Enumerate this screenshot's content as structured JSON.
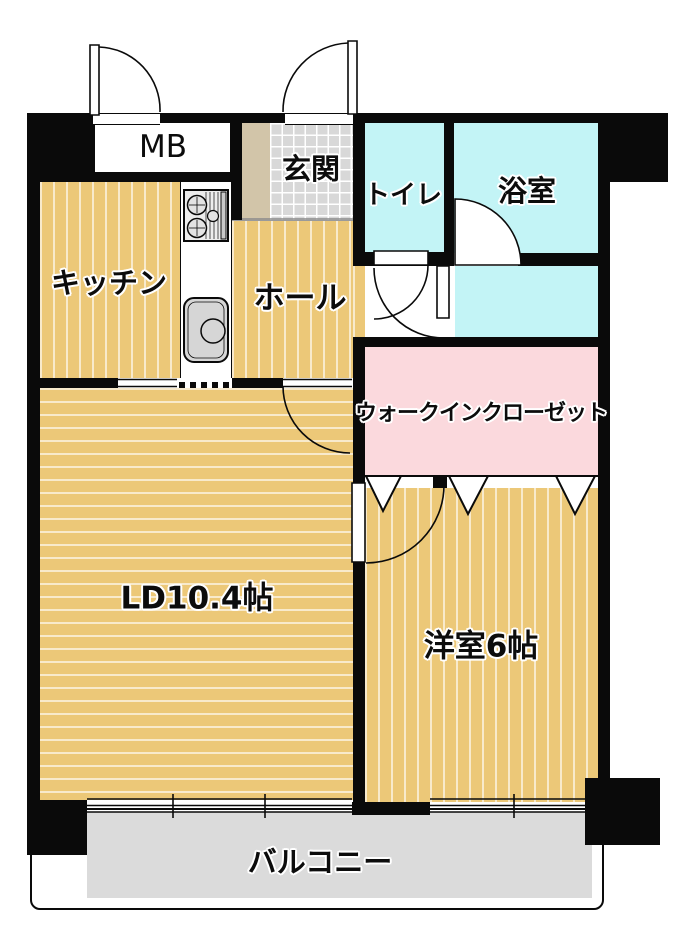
{
  "floorplan": {
    "rooms": {
      "mb": "MB",
      "genkan": "玄関",
      "toilet": "トイレ",
      "bath": "浴室",
      "kitchen": "キッチン",
      "hall": "ホール",
      "walk_in_closet": "ウォークインクローゼット",
      "living_dining": "LD10.4帖",
      "western_room": "洋室6帖",
      "balcony": "バルコニー"
    },
    "colors": {
      "wood_floor": "#ecc878",
      "wet_area_floor": "#c3f4f6",
      "closet_floor": "#fbd9dd",
      "balcony_floor": "#dbdbdb",
      "entry_tile": "#d8d8d8",
      "entry_frame": "#d2c5a9",
      "wall": "#0a0a0a"
    }
  }
}
